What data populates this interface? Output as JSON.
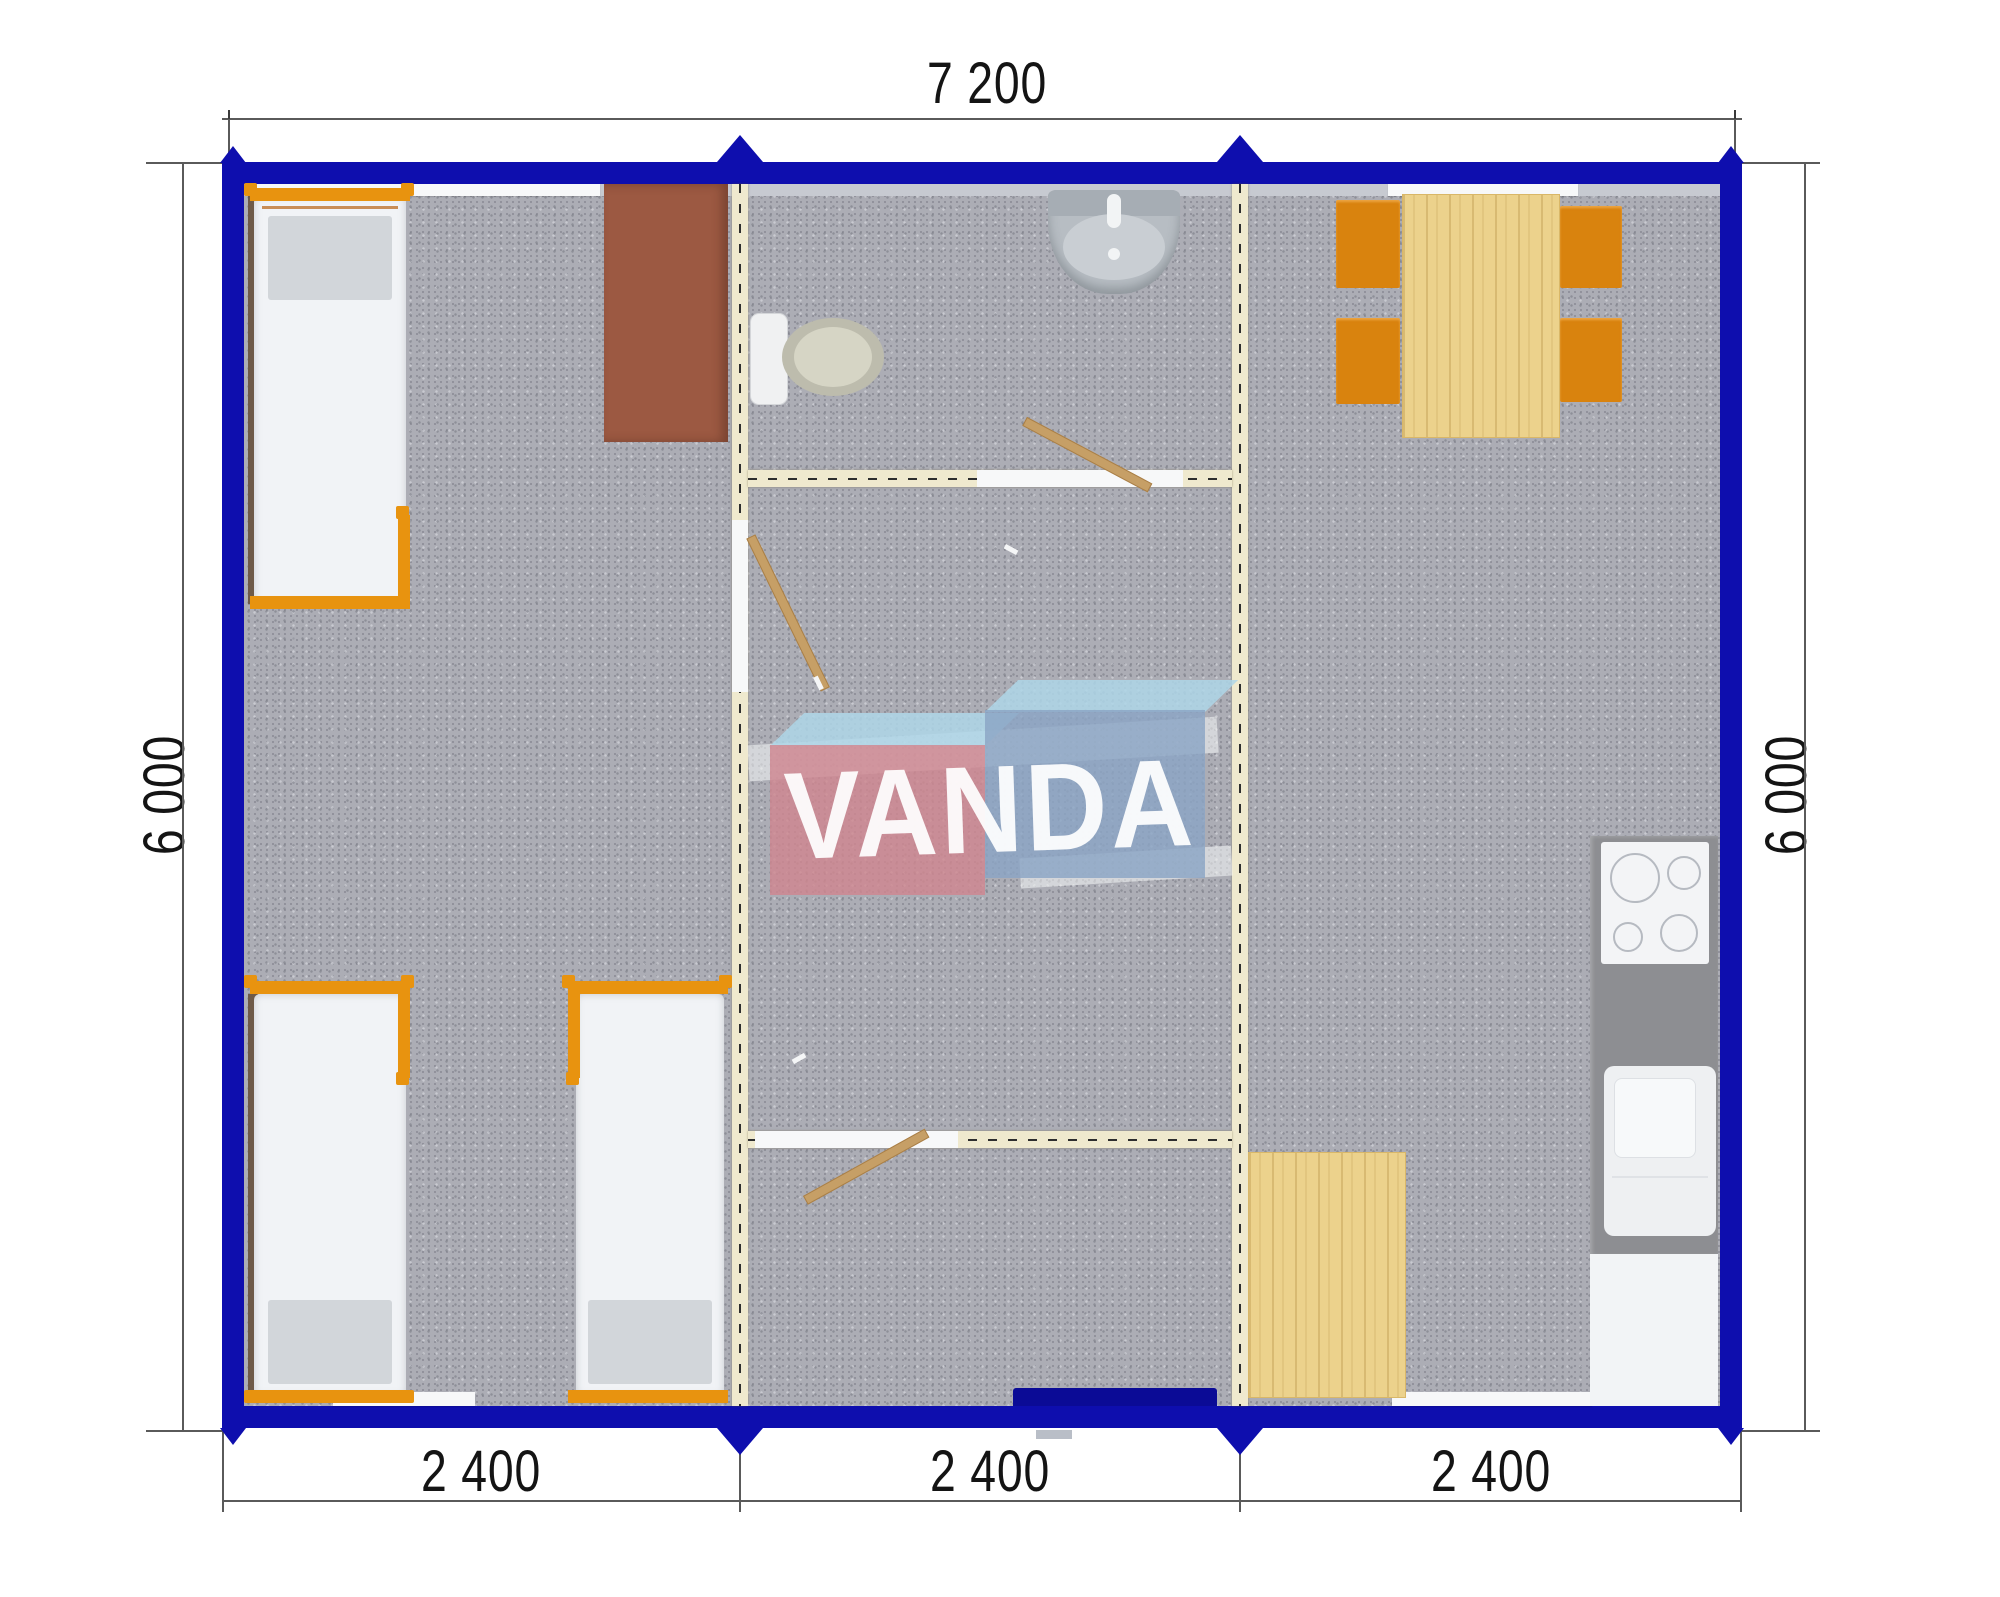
{
  "drawing": {
    "type": "floor-plan",
    "dimensions": {
      "top": {
        "label": "7 200"
      },
      "left": {
        "label": "6 000"
      },
      "right": {
        "label": "6 000"
      },
      "bottom": [
        {
          "label": "2 400"
        },
        {
          "label": "2 400"
        },
        {
          "label": "2 400"
        }
      ]
    },
    "watermark": {
      "text": "VANDA"
    },
    "modules": 3,
    "colors": {
      "exterior_wall": "#0e0eae",
      "floor": "#acadb5",
      "partition_wall": "#efe9ce",
      "furniture_orange": "#e8930f",
      "wood": "#ecd28c",
      "wardrobe_brown": "#9c5942",
      "watermark_pink": "#d08690",
      "watermark_blue": "#8ba5c4",
      "watermark_light_blue": "#aed6e8"
    },
    "rooms": {
      "left_module": {
        "furniture": [
          "single-bed",
          "single-bed",
          "single-bed",
          "wardrobe"
        ]
      },
      "middle_module": {
        "furniture": [
          "toilet",
          "wash-basin"
        ],
        "doors": 3,
        "entrance": "bottom"
      },
      "right_module": {
        "furniture": [
          "dining-table",
          "chair",
          "chair",
          "chair",
          "chair",
          "cooktop",
          "kitchen-sink",
          "kitchen-cabinet",
          "side-table"
        ]
      }
    }
  }
}
